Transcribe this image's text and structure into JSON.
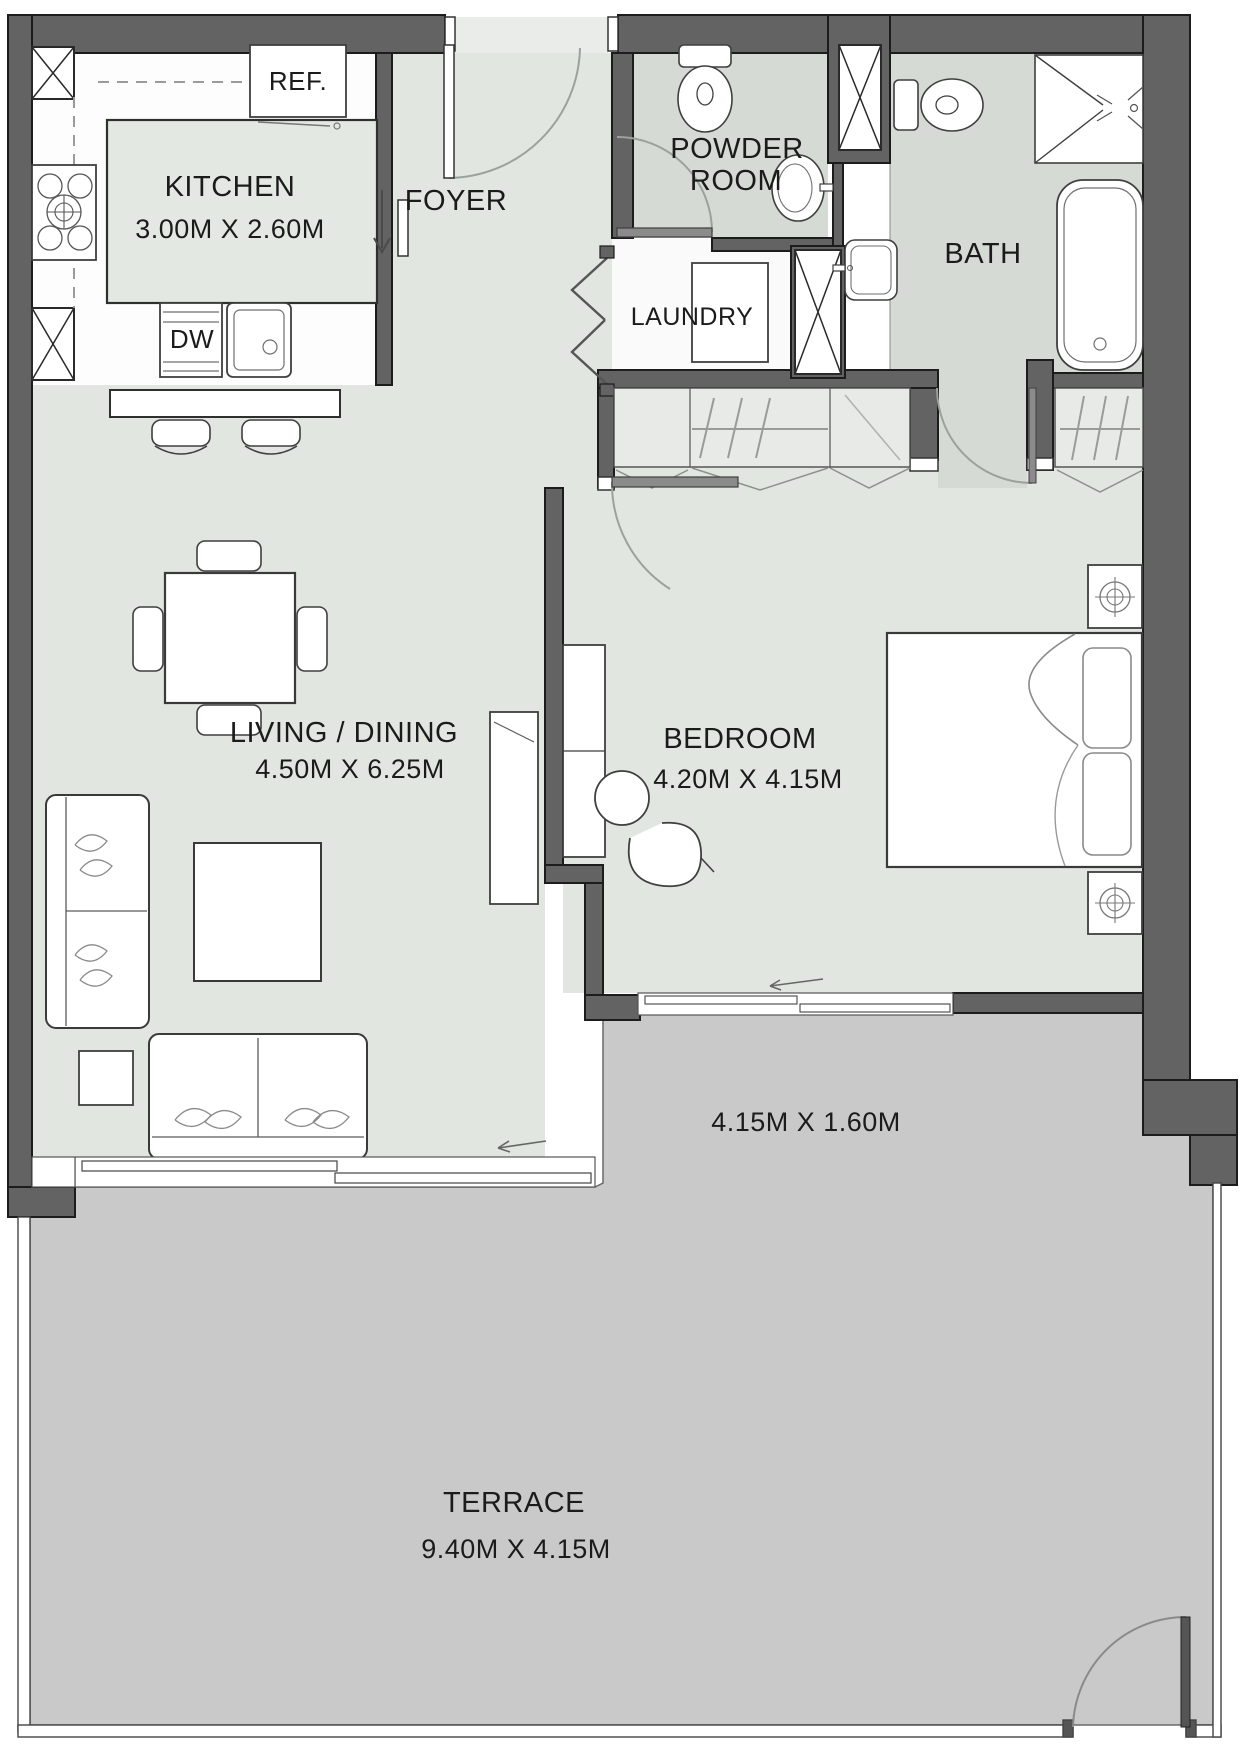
{
  "title": "Apartment Floor Plan",
  "colors": {
    "wall": "#636363",
    "wall_outline": "#1c1c1c",
    "room_floor": "#e1e6e1",
    "wet_floor": "#d5dad4",
    "kitchen_floor": "#fdfdfd",
    "terrace_floor": "#c9c9c9",
    "furniture_line": "#3f3f3f",
    "door_arc": "#9aa29a"
  },
  "rooms": {
    "kitchen": {
      "label": "KITCHEN",
      "dims": "3.00M X 2.60M"
    },
    "foyer": {
      "label": "FOYER"
    },
    "powder_room": {
      "line1": "POWDER",
      "line2": "ROOM"
    },
    "laundry": {
      "label": "LAUNDRY"
    },
    "bath": {
      "label": "BATH"
    },
    "living_dining": {
      "label": "LIVING / DINING",
      "dims": "4.50M X 6.25M"
    },
    "bedroom": {
      "label": "BEDROOM",
      "dims": "4.20M X 4.15M"
    },
    "balcony": {
      "dims": "4.15M X 1.60M"
    },
    "terrace": {
      "label": "TERRACE",
      "dims": "9.40M X 4.15M"
    }
  },
  "appliances": {
    "refrigerator": "REF.",
    "dishwasher": "DW"
  }
}
